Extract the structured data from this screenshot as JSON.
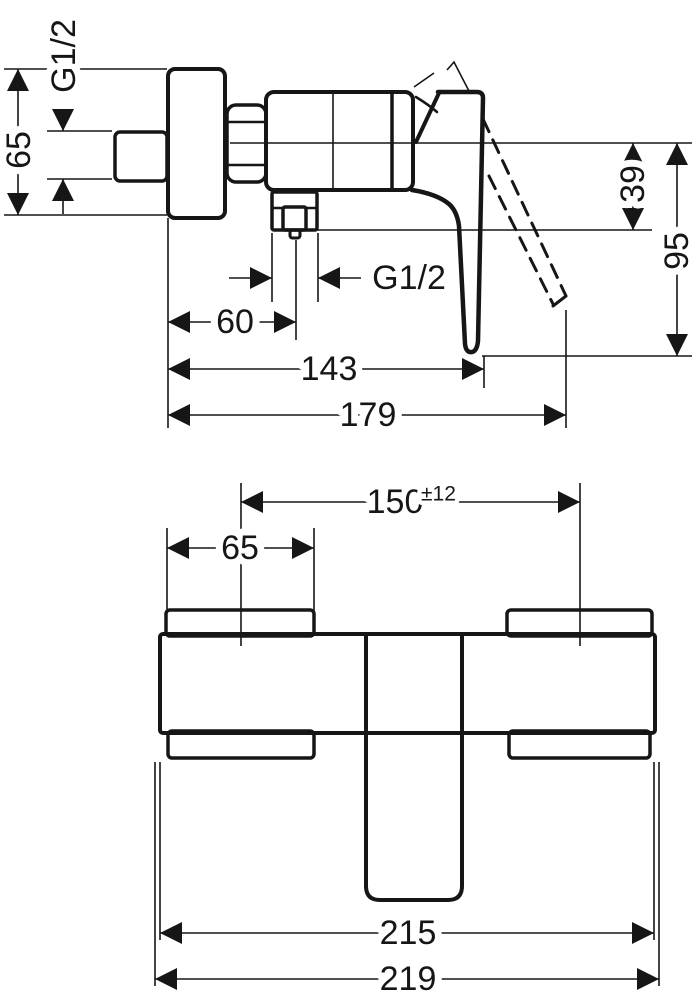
{
  "drawing": {
    "kind": "installation-dimension-drawing",
    "unit": "mm",
    "line_color": "#161616",
    "background": "#ffffff"
  },
  "side_view": {
    "inlet_thread": "G1/2",
    "flange_height": "65",
    "outlet_thread": "G1/2",
    "outlet_offset_from_wall": "60",
    "depth_to_handle": "143",
    "total_depth": "179",
    "outlet_below_center": "39",
    "handle_below_center": "95"
  },
  "front_view": {
    "escutcheon_width": "65",
    "connection_center_distance": "150",
    "connection_center_tolerance": "±12",
    "body_width": "215",
    "total_width": "219"
  }
}
